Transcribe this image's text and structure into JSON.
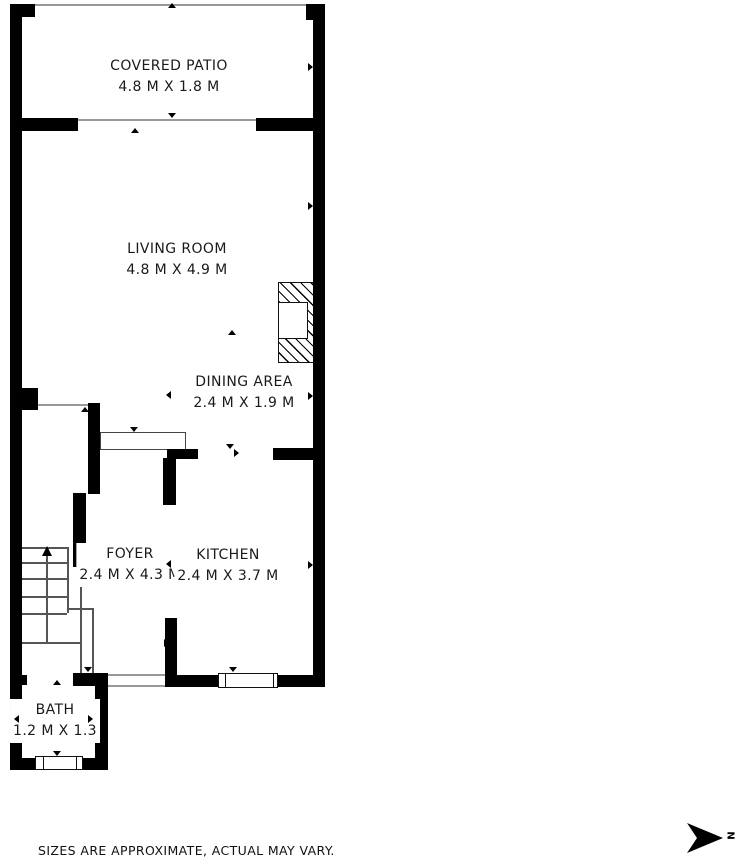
{
  "rooms": [
    {
      "id": "covered-patio",
      "label": "COVERED PATIO",
      "dims": "4.8 M X 1.8 M"
    },
    {
      "id": "living-room",
      "label": "LIVING ROOM",
      "dims": "4.8 M X 4.9 M"
    },
    {
      "id": "dining-area",
      "label": "DINING AREA",
      "dims": "2.4 M X 1.9 M"
    },
    {
      "id": "foyer",
      "label": "FOYER",
      "dims": "2.4 M X 4.3 M"
    },
    {
      "id": "kitchen",
      "label": "KITCHEN",
      "dims": "2.4 M X 3.7 M"
    },
    {
      "id": "bath",
      "label": "BATH",
      "dims": "1.2 M X 1.3"
    }
  ],
  "footer": {
    "disclaimer": "SIZES ARE APPROXIMATE, ACTUAL MAY VARY."
  },
  "compass": {
    "label": "N"
  },
  "colors": {
    "wall": "#000000",
    "thin_line": "#999999",
    "text": "#1a1a1a",
    "background": "#ffffff"
  }
}
